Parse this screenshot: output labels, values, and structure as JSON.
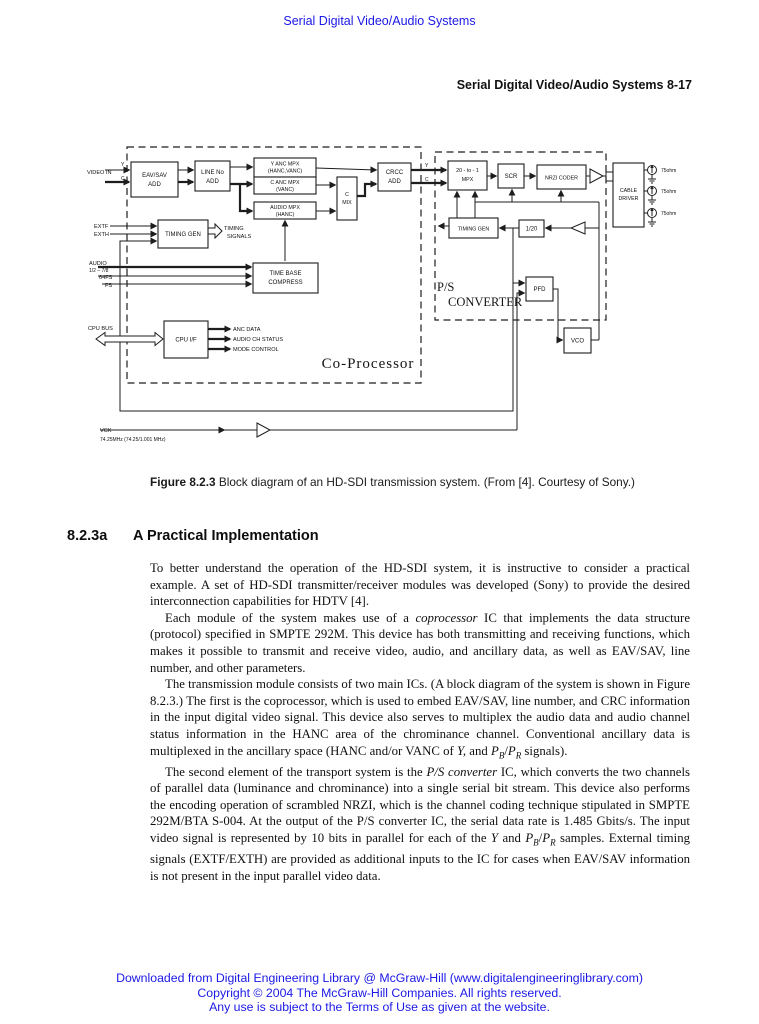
{
  "page": {
    "top_link": "Serial Digital Video/Audio Systems",
    "running_header": "Serial Digital Video/Audio Systems 8-17",
    "caption": {
      "label": "Figure 8.2.3",
      "text": " Block diagram of an HD-SDI transmission system. (From [4]. Courtesy of Sony.)"
    },
    "section": {
      "number": "8.2.3a",
      "title": "A Practical Implementation"
    },
    "body": {
      "p1": [
        {
          "t": "To better understand the operation of the HD-SDI system, it is instructive to consider a practical example. A set of HD-SDI transmitter/receiver modules was developed (Sony) to provide the desired interconnection capabilities for HDTV [4]."
        }
      ],
      "p2": [
        {
          "t": "Each module of the system makes use of a "
        },
        {
          "t": "coprocessor",
          "i": 1
        },
        {
          "t": " IC that implements the data structure (protocol) specified in SMPTE 292M. This device has both transmitting and receiving functions, which makes it possible to transmit and receive video, audio, and ancillary data, as well as EAV/SAV, line number, and other parameters."
        }
      ],
      "p3": [
        {
          "t": "The transmission module consists of two main ICs. (A block diagram of the system is shown in Figure 8.2.3.) The first is the coprocessor, which is used to embed EAV/SAV, line number, and CRC information in the input digital video signal. This device also serves to multiplex the audio data and audio channel status information in the HANC area of the chrominance channel. Conventional ancillary data is multiplexed in the ancillary space (HANC and/or VANC of "
        },
        {
          "t": "Y,",
          "i": 1
        },
        {
          "t": " and "
        },
        {
          "t": "P",
          "i": 1
        },
        {
          "t": "B",
          "i": 1,
          "sub": 1
        },
        {
          "t": "/"
        },
        {
          "t": "P",
          "i": 1
        },
        {
          "t": "R",
          "i": 1,
          "sub": 1
        },
        {
          "t": " signals)."
        }
      ],
      "p4": [
        {
          "t": "The second element of the transport system is the "
        },
        {
          "t": "P/S converter",
          "i": 1
        },
        {
          "t": " IC, which converts the two channels of parallel data (luminance and chrominance) into a single serial bit stream. This device also performs the encoding operation of scrambled NRZI, which is the channel coding technique stipulated in SMPTE 292M/BTA S-004. At the output of the P/S converter IC, the serial data rate is 1.485 Gbits/s. The input video signal is represented by 10 bits in parallel for each of the "
        },
        {
          "t": "Y",
          "i": 1
        },
        {
          "t": " and "
        },
        {
          "t": "P",
          "i": 1
        },
        {
          "t": "B",
          "i": 1,
          "sub": 1
        },
        {
          "t": "/"
        },
        {
          "t": "P",
          "i": 1
        },
        {
          "t": "R",
          "i": 1,
          "sub": 1
        },
        {
          "t": " samples. External timing signals (EXTF/EXTH) are provided as additional inputs to the IC for cases when EAV/SAV information is not present in the input parallel video data."
        }
      ]
    },
    "footer_lines": [
      "Downloaded from Digital Engineering Library @ McGraw-Hill (www.digitalengineeringlibrary.com)",
      "Copyright © 2004 The McGraw-Hill Companies. All rights reserved.",
      "Any use is subject to the Terms of Use as given at the website."
    ]
  },
  "diagram": {
    "blocks": {
      "eav_sav": {
        "l1": "EAV/SAV",
        "l2": "ADD"
      },
      "line_no": {
        "l1": "LINE No",
        "l2": "ADD"
      },
      "y_anc": {
        "l1": "Y ANC MPX",
        "l2": "(HANC,VANC)"
      },
      "c_anc": {
        "l1": "C ANC MPX",
        "l2": "(VANC)"
      },
      "audio_mpx": {
        "l1": "AUDIO MPX",
        "l2": "(HANC)"
      },
      "c_mix": {
        "l1": "C",
        "l2": "MIX"
      },
      "crcc": {
        "l1": "CRCC",
        "l2": "ADD"
      },
      "timing_gen_co": {
        "l1": "TIMING GEN"
      },
      "time_base": {
        "l1": "TIME BASE",
        "l2": "COMPRESS"
      },
      "cpu_if": {
        "l1": "CPU I/F"
      },
      "mpx20": {
        "l1": "20 - to - 1",
        "l2": "MPX"
      },
      "scr": {
        "l1": "SCR"
      },
      "nrzi": {
        "l1": "NRZI CODER"
      },
      "cable_driver": {
        "l1": "CABLE",
        "l2": "DRIVER"
      },
      "timing_gen_ps": {
        "l1": "TIMING GEN"
      },
      "div20": {
        "l1": "1/20"
      },
      "pfd": {
        "l1": "PFD"
      },
      "vco": {
        "l1": "VCO"
      }
    },
    "labels": {
      "video_in": "VIDEO IN",
      "y_in": "Y",
      "c_in": "C",
      "extf": "EXTF",
      "exth": "EXTH",
      "timing1": "TIMING",
      "timing2": "SIGNALS",
      "audio": "AUDIO",
      "audio_ch": "1/2 – 7/8",
      "fs64": "64FS",
      "fs": "FS",
      "cpu_bus": "CPU BUS",
      "anc_data": "ANC DATA",
      "audio_status": "AUDIO CH STATUS",
      "mode_ctrl": "MODE CONTROL",
      "coprocessor": "Co-Processor",
      "ps1": "P/S",
      "ps2": "CONVERTER",
      "y_out": "Y",
      "c_out": "C",
      "vck": "VCK",
      "vck_freq": "74.25MHz (74.25/1.001 MHz)",
      "ohm1": "75ohm",
      "ohm2": "75ohm",
      "ohm3": "75ohm"
    }
  }
}
